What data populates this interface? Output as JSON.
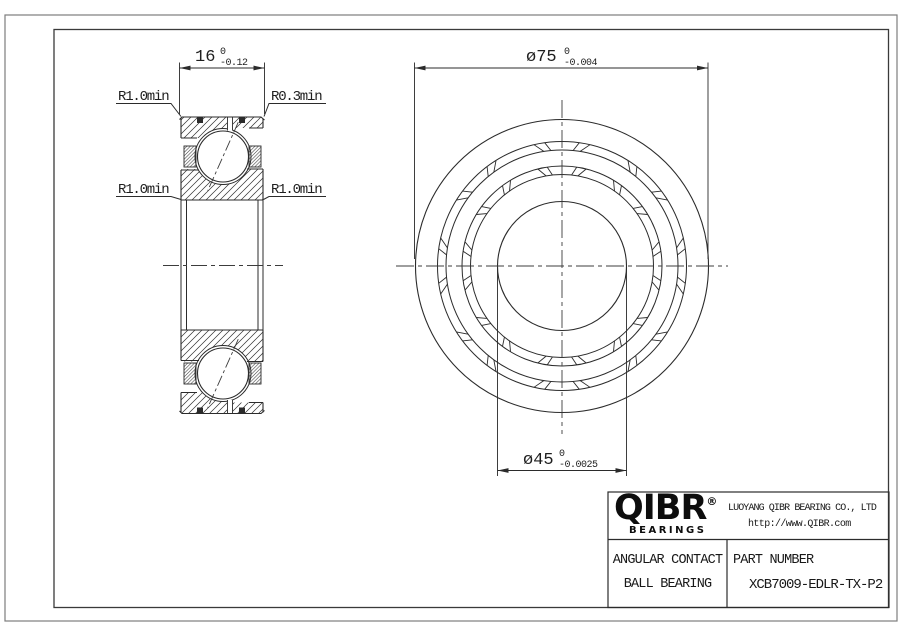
{
  "section_view": {
    "width_dim": {
      "value": "16",
      "tol_upper": "0",
      "tol_lower": "-0.12"
    },
    "radius_labels": {
      "top_left": "R1.0min",
      "top_right": "R0.3min",
      "mid_left": "R1.0min",
      "mid_right": "R1.0min"
    }
  },
  "front_view": {
    "outer_dia_dim": {
      "value": "ø75",
      "tol_upper": "0",
      "tol_lower": "-0.004"
    },
    "bore_dia_dim": {
      "value": "ø45",
      "tol_upper": "0",
      "tol_lower": "-0.0025"
    }
  },
  "title_block": {
    "logo_text": "QIBR",
    "logo_registered": "®",
    "logo_subtext": "BEARINGS",
    "company_name": "LUOYANG QIBR BEARING CO., LTD",
    "website": "http://www.QIBR.com",
    "product_type_line1": "ANGULAR CONTACT",
    "product_type_line2": "BALL BEARING",
    "part_number_label": "PART NUMBER",
    "part_number": "XCB7009-EDLR-TX-P2"
  },
  "colors": {
    "line": "#2b2b2b",
    "sheet": "#ffffff",
    "border_outer": "#7d7d7d"
  }
}
